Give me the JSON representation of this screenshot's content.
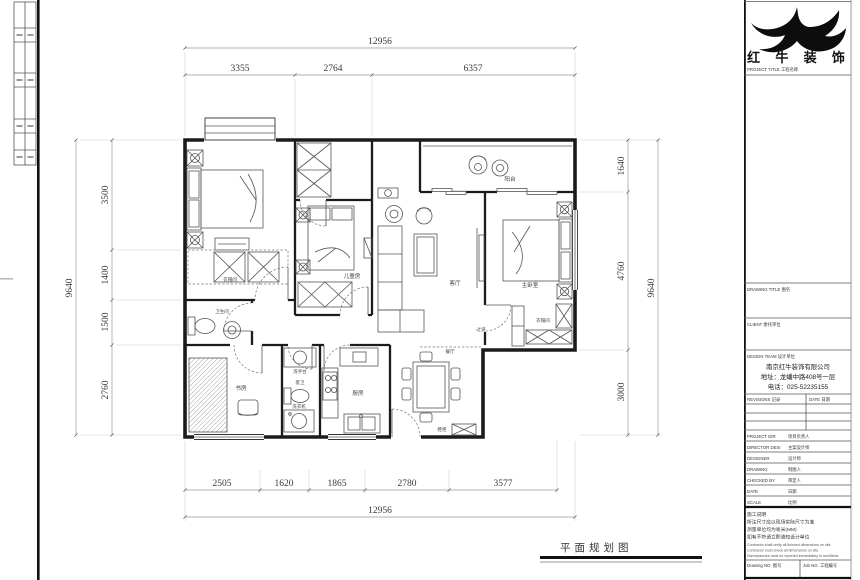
{
  "plan": {
    "title": "平面规划图",
    "dims": {
      "top_total": "12956",
      "top_segs": [
        "3355",
        "2764",
        "6357"
      ],
      "left_total": "9640",
      "left_segs": [
        "3500",
        "1400",
        "1500",
        "2760"
      ],
      "right_total": "9640",
      "right_segs": [
        "1640",
        "4760",
        "3000"
      ],
      "bottom_total": "12956",
      "bottom_segs": [
        "2505",
        "1620",
        "1865",
        "2780",
        "3577"
      ]
    },
    "rooms": {
      "bedroom_closet": "衣帽间",
      "kids": "儿童房",
      "living": "客厅",
      "balcony": "阳台",
      "master": "主卧室",
      "bath": "卫生间",
      "study": "书房",
      "hall": "过道",
      "washstand": "洗手台",
      "guest_bath": "客卫",
      "laundry": "洗衣机",
      "kitchen": "厨房",
      "dining": "餐厅",
      "shoe": "鞋柜",
      "master_closet": "衣帽间"
    }
  },
  "title_block": {
    "brand": "红 牛 装 饰",
    "project_line": "PROJECT TITLE  工程名称",
    "drawing_title": "DRAWING TITLE  图名",
    "client": "CLIENT  委托单位",
    "design_team": "DESIGN TEAM  设计单位",
    "company": [
      "南京红牛装饰有限公司",
      "地址：龙蟠中路408号一层",
      "电话：025-52235155"
    ],
    "revisions": "REVISIONS  记录",
    "rev_date": "DATE  日期",
    "rows": [
      {
        "en": "PROJECT DIR",
        "cn": "项目负责人"
      },
      {
        "en": "DIRECTOR DESI",
        "cn": "主案设计师"
      },
      {
        "en": "DESIGNER",
        "cn": "设计师"
      },
      {
        "en": "DRAWING",
        "cn": "制图人"
      },
      {
        "en": "CHECKED BY",
        "cn": "审定人"
      },
      {
        "en": "DATE",
        "cn": "日期"
      },
      {
        "en": "SCALE",
        "cn": "比例"
      }
    ],
    "notes_cn": [
      "施工说明",
      "所注尺寸应以现场实际尺寸为准",
      "测量单位均为毫米(MM)",
      "如有不符请立即通知设计单位"
    ],
    "notes_en": [
      "Contractor shall verify all finished dimensions on site.",
      "Contractor must check all dimensions on site.",
      "Discrepancies must be reported immediately to architects."
    ],
    "drawing_no": "Drawing NO.  图号",
    "job_no": "Job NO.  工程编号"
  }
}
